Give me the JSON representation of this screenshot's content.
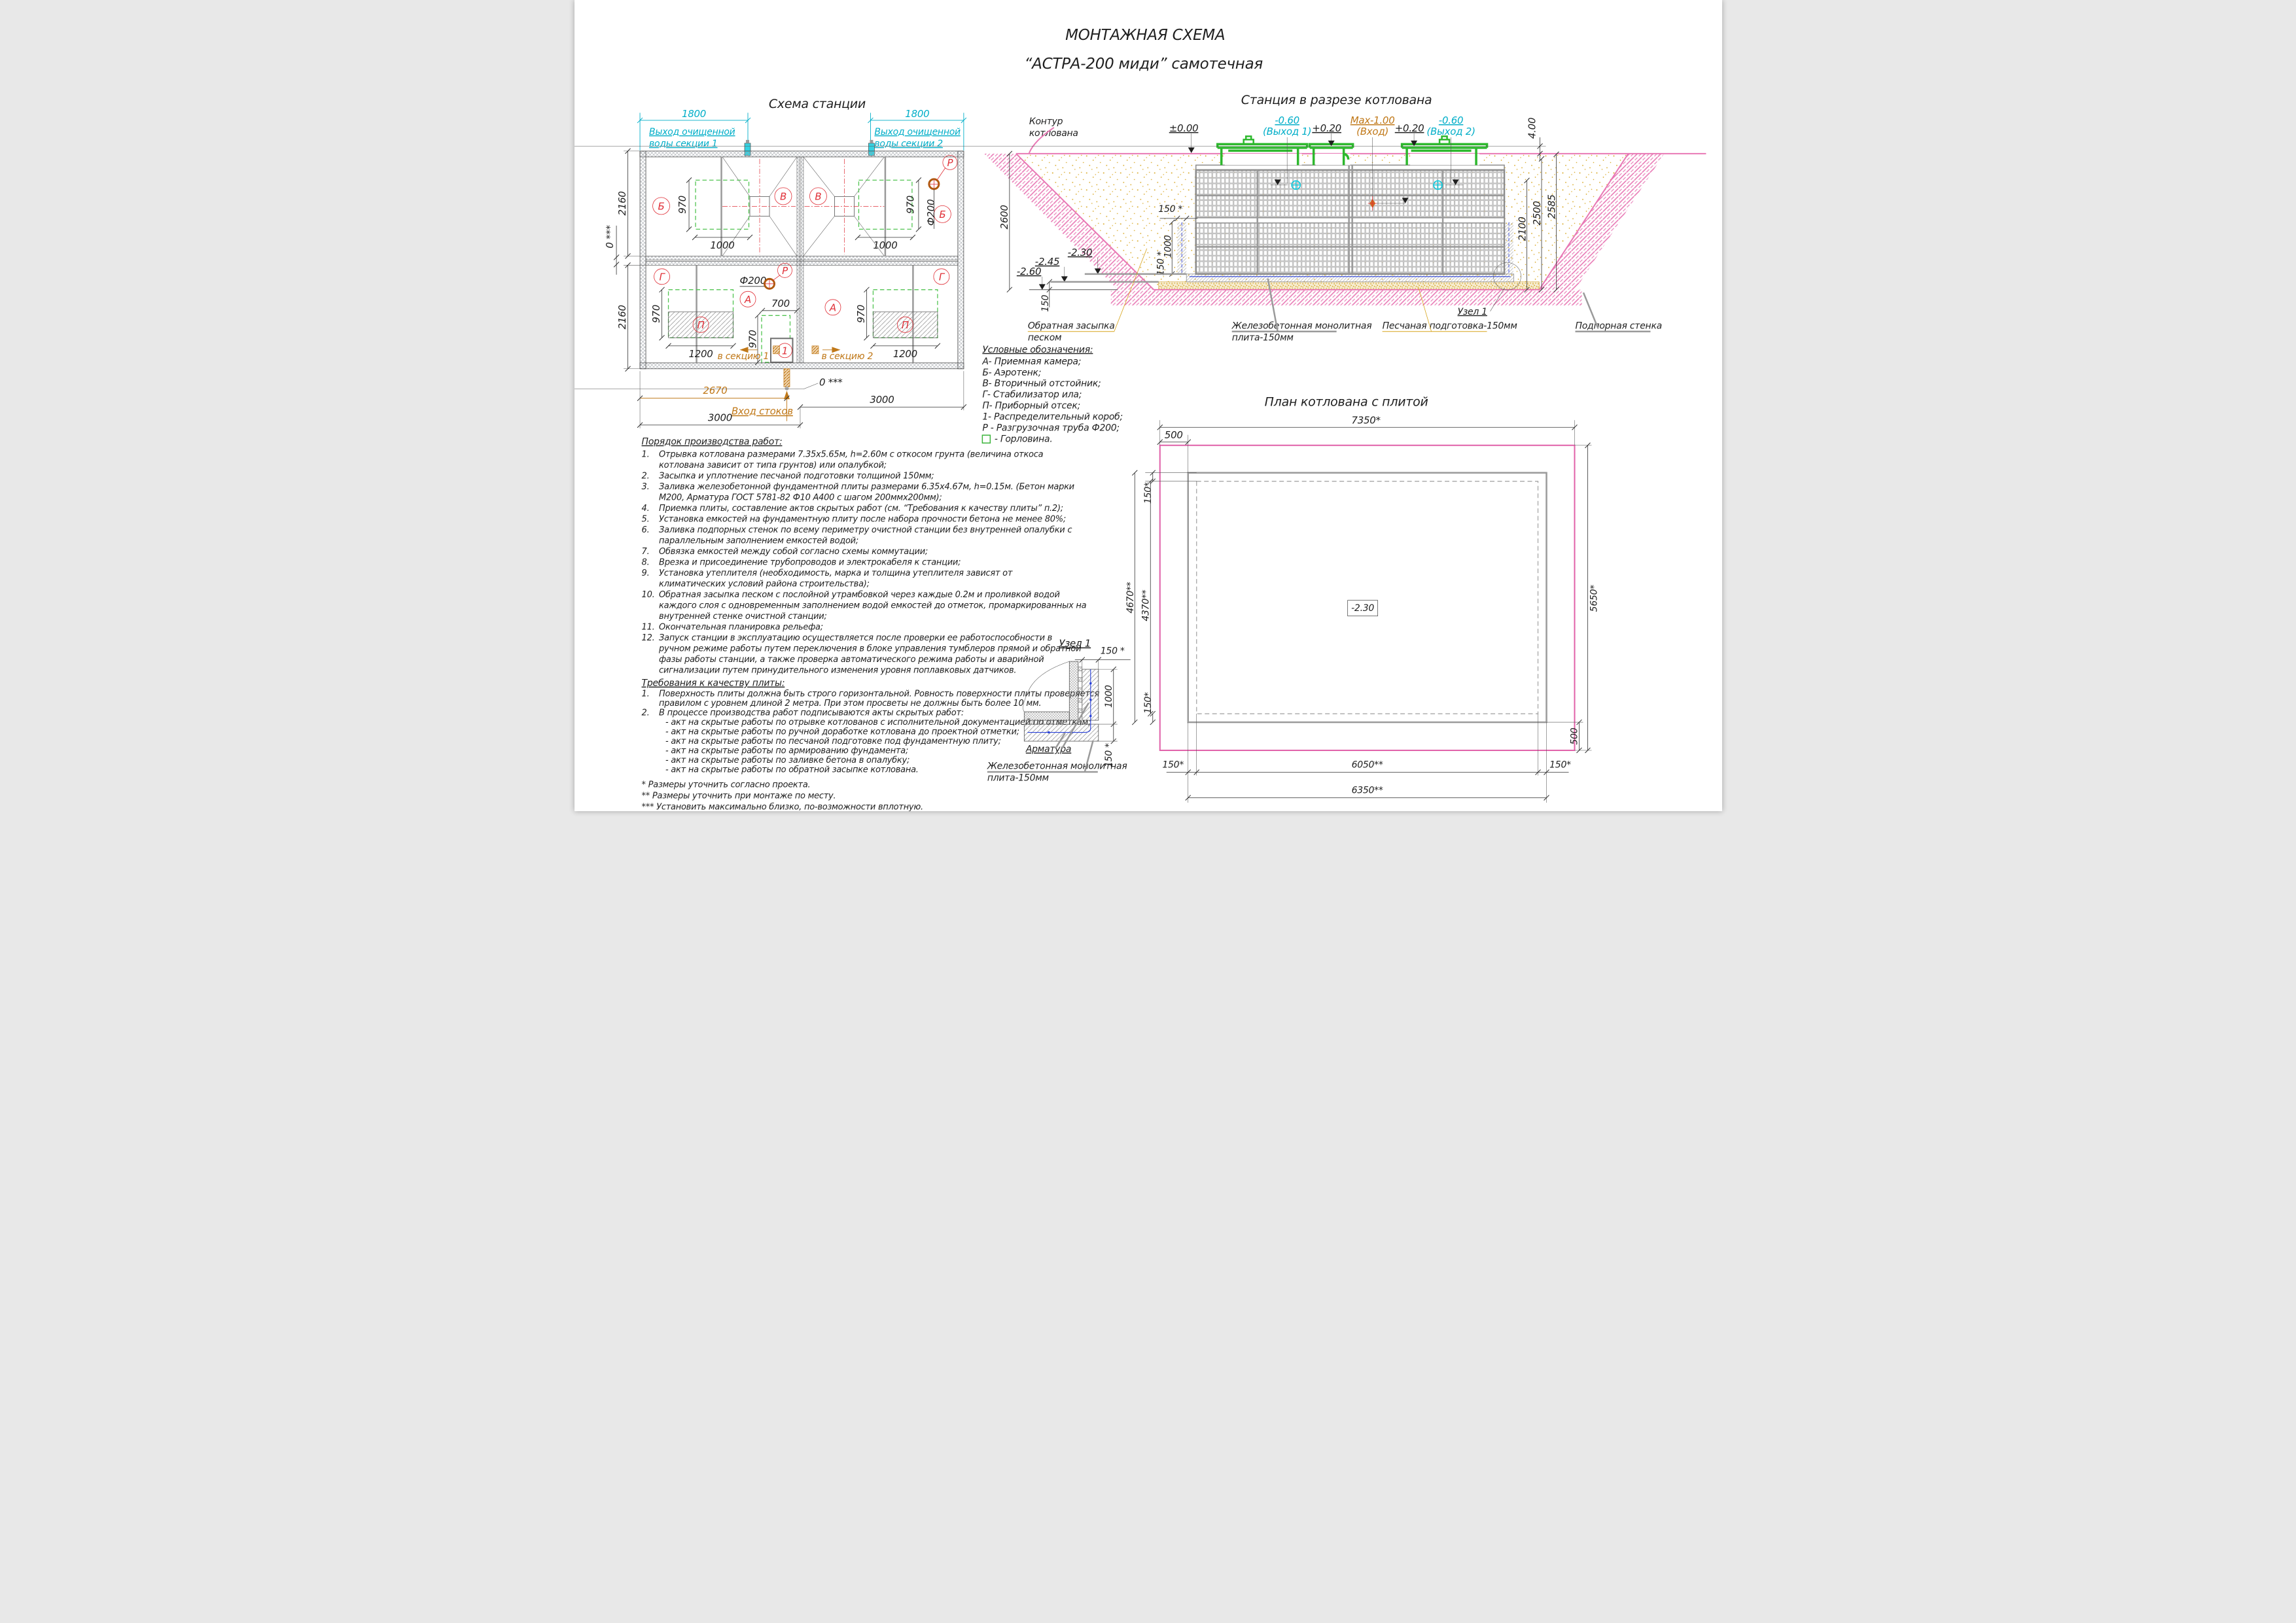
{
  "title": {
    "line1": "МОНТАЖНАЯ СХЕМА",
    "line2": "“АСТРА-200 миди” самотечная"
  },
  "colors": {
    "accent_cyan": "#00aec8",
    "accent_orange": "#c07818",
    "accent_red": "#e03038",
    "accent_green": "#2fae2f",
    "accent_pink": "#e878b4",
    "rebar_blue": "#2840d8",
    "sand": "#d7a51d"
  },
  "station_plan": {
    "title": "Схема станции",
    "dim_1800": "1800",
    "outlet1_l1": "Выход очищенной",
    "outlet1_l2": "воды секции 1",
    "outlet2_l1": "Выход очищенной",
    "outlet2_l2": "воды секции 2",
    "dim_2160": "2160",
    "dim_zero": "0 ***",
    "dim_970": "970",
    "dim_1000": "1000",
    "dim_700": "700",
    "dim_1200": "1200",
    "dim_2670": "2670",
    "dim_3000": "3000",
    "phi200": "Ф200",
    "labels": {
      "A": "А",
      "B": "Б",
      "V": "В",
      "G": "Г",
      "P": "П",
      "R": "Р",
      "box1": "1"
    },
    "inlet": "Вход стоков",
    "to_section1": "в секцию 1",
    "to_section2": "в секцию 2"
  },
  "section": {
    "title": "Станция в разрезе котлована",
    "contour_l1": "Контур",
    "contour_l2": "котлована",
    "lvl_000": "±0.00",
    "lvl_m060": "-0.60",
    "out1": "(Выход 1)",
    "lvl_p020": "+0.20",
    "lvl_max": "Мах-1.00",
    "inlet": "(Вход)",
    "out2": "(Выход 2)",
    "dim_400": "4.00",
    "dim_2600": "2600",
    "dim_2100": "2100",
    "dim_2500": "2500",
    "dim_2585": "2585",
    "dim_150s": "150 *",
    "dim_1000": "1000",
    "dim_150": "150",
    "lvl_m230": "-2.30",
    "lvl_m245": "-2.45",
    "lvl_m260": "-2.60",
    "backfill_l1": "Обратная засыпка",
    "backfill_l2": "песком",
    "plate_l1": "Железобетонная монолитная",
    "plate_l2": "плита-150мм",
    "node1": "Узел 1",
    "sand_prep": "Песчаная подготовка-150мм",
    "ret_wall": "Подпорная стенка"
  },
  "legend": {
    "title": "Условные обозначения:",
    "items": [
      "А- Приемная камера;",
      "Б- Аэротенк;",
      "В- Вторичный отстойник;",
      "Г- Стабилизатор ила;",
      "П- Приборный отсек;",
      "1- Распределительный короб;",
      "Р - Разгрузочная труба Ф200;",
      "- Горловина."
    ]
  },
  "work_order": {
    "title": "Порядок производства работ:",
    "lines": [
      {
        "n": "1.",
        "t": "Отрывка котлована размерами 7.35х5.65м, h=2.60м с откосом грунта (величина откоса"
      },
      {
        "n": "",
        "t": "котлована зависит от типа грунтов) или опалубкой;"
      },
      {
        "n": "2.",
        "t": "Засыпка и уплотнение песчаной подготовки толщиной 150мм;"
      },
      {
        "n": "3.",
        "t": "Заливка железобетонной фундаментной плиты размерами 6.35х4.67м, h=0.15м. (Бетон марки"
      },
      {
        "n": "",
        "t": "М200, Арматура ГОСТ 5781-82 Ф10 А400 с шагом 200ммх200мм);"
      },
      {
        "n": "4.",
        "t": "Приемка плиты, составление актов скрытых работ (см. “Требования к качеству плиты” п.2);"
      },
      {
        "n": "5.",
        "t": "Установка емкостей на фундаментную плиту после набора прочности бетона не менее  80%;"
      },
      {
        "n": "6.",
        "t": "Заливка подпорных стенок по всему периметру очистной станции без внутренней опалубки с"
      },
      {
        "n": "",
        "t": "параллельным заполнением емкостей водой;"
      },
      {
        "n": "7.",
        "t": "Обвязка емкостей между собой согласно схемы коммутации;"
      },
      {
        "n": "8.",
        "t": "Врезка и присоединение трубопроводов и электрокабеля к станции;"
      },
      {
        "n": "9.",
        "t": "Установка утеплителя (необходимость, марка и толщина утеплителя зависят от"
      },
      {
        "n": "",
        "t": "климатических условий района строительства);"
      },
      {
        "n": "10.",
        "t": "Обратная засыпка песком с послойной утрамбовкой через каждые  0.2м и проливкой водой"
      },
      {
        "n": "",
        "t": "каждого слоя с одновременным заполнением водой емкостей до отметок, промаркированных на"
      },
      {
        "n": "",
        "t": "внутренней стенке очистной станции;"
      },
      {
        "n": "11.",
        "t": "Окончательная планировка рельефа;"
      },
      {
        "n": "12.",
        "t": "Запуск станции в эксплуатацию осуществляется после проверки ее работоспособности в"
      },
      {
        "n": "",
        "t": "ручном режиме работы путем переключения в блоке управления тумблеров прямой и обратной"
      },
      {
        "n": "",
        "t": "фазы работы станции, а также проверка автоматического режима работы и аварийной"
      },
      {
        "n": "",
        "t": "сигнализации путем принудительного изменения уровня поплавковых датчиков."
      }
    ]
  },
  "requirements": {
    "title": "Требования к качеству плиты:",
    "lines": [
      {
        "n": "1.",
        "t": "Поверхность плиты должна быть строго горизонтальной. Ровность поверхности плиты проверяется"
      },
      {
        "n": "",
        "t": "правилом с уровнем длиной 2 метра. При этом просветы не должны быть более 10 мм."
      },
      {
        "n": "2.",
        "t": "В процессе производства работ подписываются акты скрытых работ:"
      },
      {
        "n": "",
        "t": "- акт на скрытые работы по отрывке котлованов с исполнительной документацией по отметкам;"
      },
      {
        "n": "",
        "t": "- акт на скрытые работы по ручной доработке котлована до проектной отметки;"
      },
      {
        "n": "",
        "t": "- акт на скрытые работы по песчаной подготовке под фундаментную плиту;"
      },
      {
        "n": "",
        "t": "- акт на скрытые работы по армированию фундамента;"
      },
      {
        "n": "",
        "t": "- акт на скрытые работы по заливке бетона в опалубку;"
      },
      {
        "n": "",
        "t": "- акт на скрытые работы по обратной засыпке котлована."
      }
    ]
  },
  "node_detail": {
    "title": "Узел 1",
    "dim_150_top": "150 *",
    "dim_1000": "1000",
    "dim_150_bot": "150 *",
    "rebar": "Арматура",
    "plate_l1": "Железобетонная монолитная",
    "plate_l2": "плита-150мм"
  },
  "pit_plan": {
    "title": "План котлована с плитой",
    "dim_7350": "7350*",
    "dim_500": "500",
    "dim_150": "150*",
    "dim_4670": "4670**",
    "dim_4370": "4370**",
    "dim_5650": "5650*",
    "lvl": "-2.30",
    "dim_6050": "6050**",
    "dim_6350": "6350**"
  },
  "footnotes": [
    "* Размеры уточнить согласно проекта.",
    "** Размеры уточнить при монтаже по месту.",
    "*** Установить максимально близко, по-возможности вплотную."
  ]
}
